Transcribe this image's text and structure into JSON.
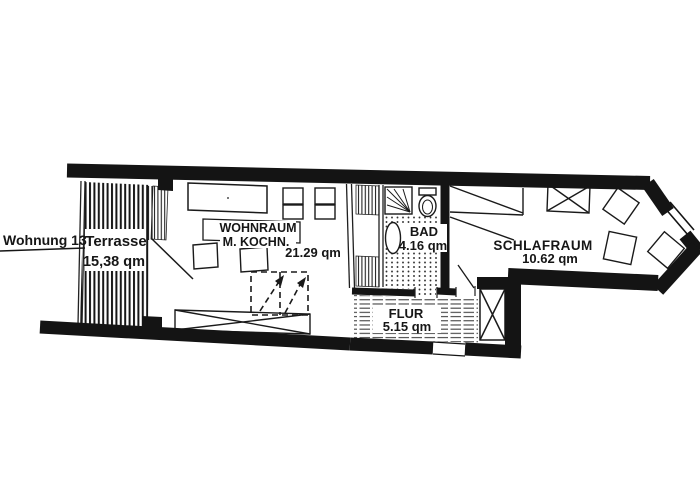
{
  "title": {
    "label": "Wohnung 13"
  },
  "rooms": {
    "terrasse": {
      "name": "Terrasse",
      "area": "15,38 qm"
    },
    "wohnraum": {
      "name": "WOHNRAUM",
      "subtitle": "M. KOCHN.",
      "area": "21.29 qm"
    },
    "bad": {
      "name": "BAD",
      "area": "4.16 qm"
    },
    "schlafraum": {
      "name": "SCHLAFRAUM",
      "area": "10.62 qm"
    },
    "flur": {
      "name": "FLUR",
      "area": "5.15 qm"
    }
  },
  "colors": {
    "wall": "#141414",
    "line": "#222222",
    "text": "#161616",
    "background": "#ffffff"
  }
}
